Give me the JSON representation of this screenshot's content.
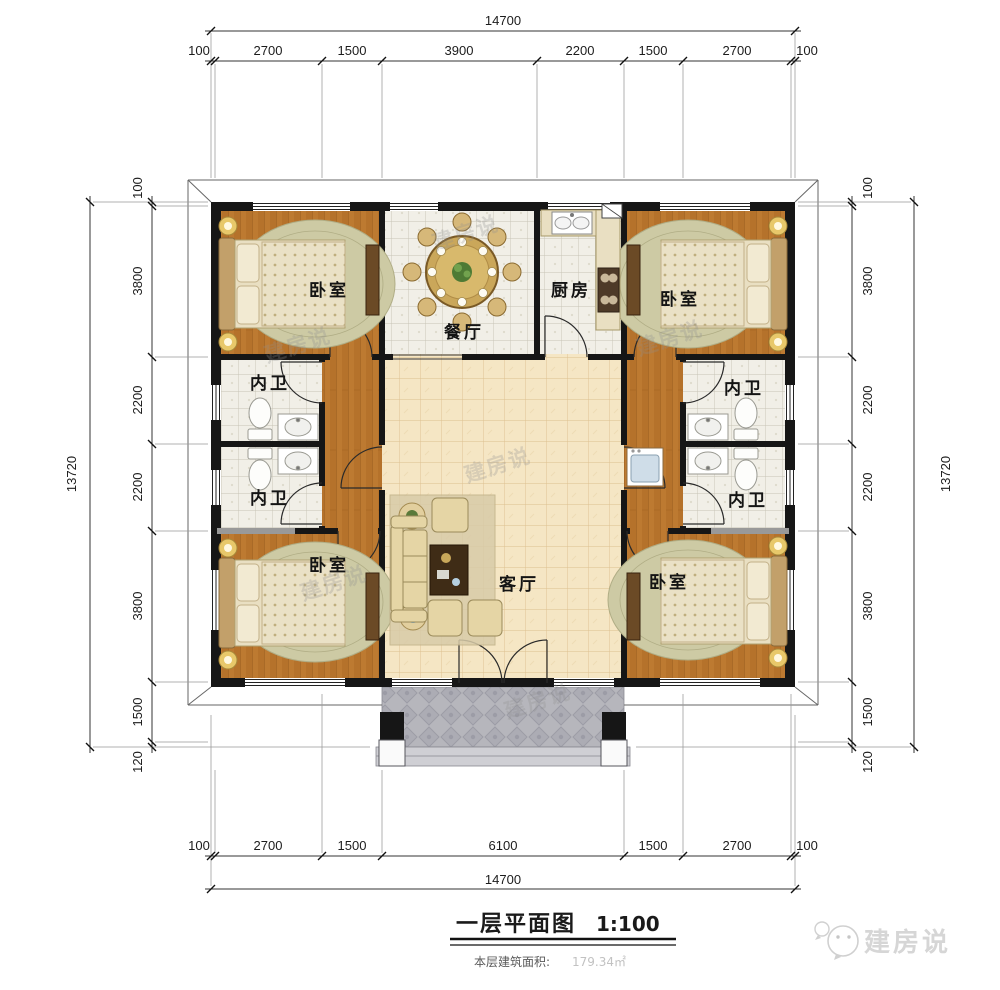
{
  "title": {
    "text": "一层平面图",
    "scale": "1:100"
  },
  "area_note": {
    "label": "本层建筑面积:",
    "value": "179.34㎡"
  },
  "logo": {
    "text": "建房说"
  },
  "watermark": {
    "text": "建房说"
  },
  "rooms": {
    "bedroom": "卧室",
    "dining": "餐厅",
    "kitchen": "厨房",
    "bath": "内卫",
    "living": "客厅"
  },
  "dims": {
    "top_total": "14700",
    "top_segments": [
      "100",
      "2700",
      "1500",
      "3900",
      "2200",
      "1500",
      "2700",
      "100"
    ],
    "bottom_total": "14700",
    "bottom_segments": [
      "100",
      "2700",
      "1500",
      "6100",
      "1500",
      "2700",
      "100"
    ],
    "left_total": "13720",
    "left_segments": [
      "100",
      "3800",
      "2200",
      "2200",
      "3800",
      "1500",
      "120"
    ],
    "right_total": "13720",
    "right_segments": [
      "100",
      "3800",
      "2200",
      "2200",
      "3800",
      "1500",
      "120"
    ]
  },
  "colors": {
    "wall": "#161616",
    "wood": "#b5722b",
    "tile": "#f1efe7",
    "cream": "#f5e6c4",
    "porch": "#b6b6bc"
  }
}
